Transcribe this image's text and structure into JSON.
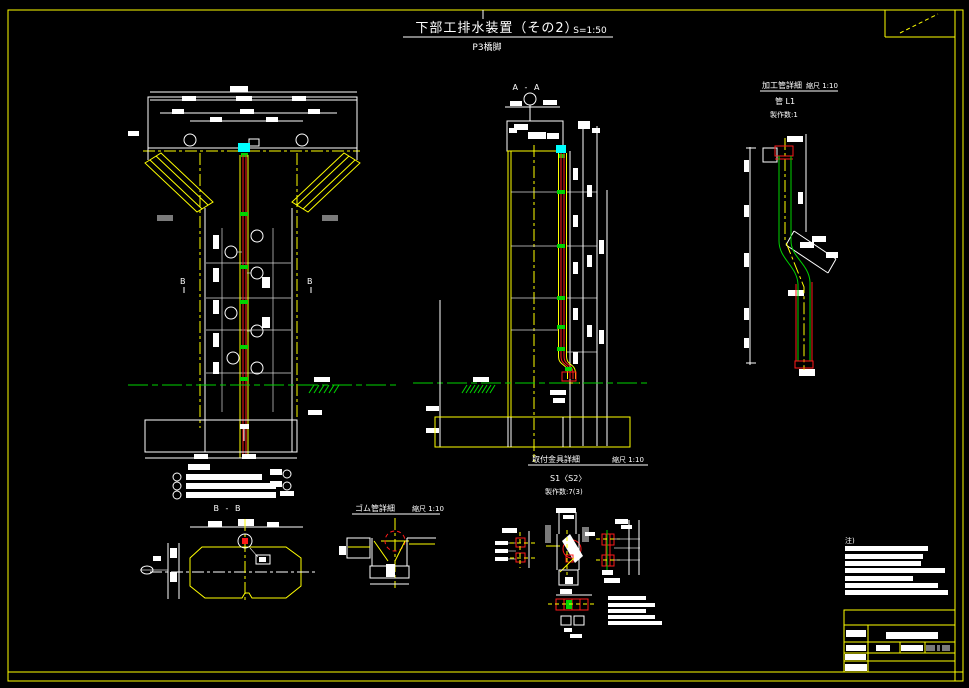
{
  "sheet": {
    "bg": "#000000",
    "frame_color": "#ffff00"
  },
  "title": {
    "text": "下部工排水装置（その2）",
    "scale": "S=1:50",
    "subtitle": "P3橋脚"
  },
  "views": {
    "elevation": {
      "marker_left": "B",
      "marker_right": "B"
    },
    "section_a": {
      "label": "A - A"
    },
    "section_b": {
      "label": "B - B"
    },
    "pipe_detail": {
      "title": "加工管詳細",
      "scale": "縮尺 1:10",
      "item": "管 L1",
      "count": "製作数:1"
    },
    "rubber_detail": {
      "title": "ゴム管詳細",
      "scale": "縮尺 1:10"
    },
    "bracket_detail": {
      "title": "取付金具詳細",
      "scale": "縮尺 1:10",
      "item": "S1〈S2〉",
      "count": "製作数:7(3)"
    },
    "notes": {
      "header": "注)"
    }
  },
  "colors": {
    "line": "#ffffff",
    "center": "#ffff00",
    "pipe": "#ff1a1a",
    "fitting": "#00ffff",
    "ground": "#00d400",
    "pad": "#7a7a7a"
  }
}
